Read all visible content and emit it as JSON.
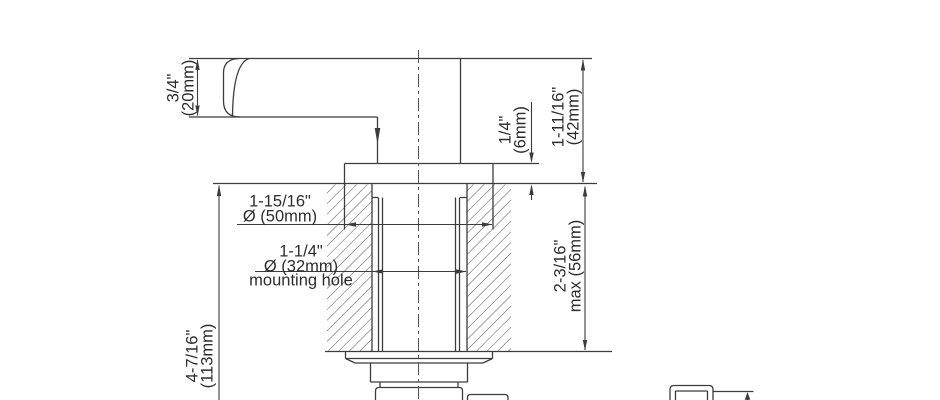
{
  "drawing": {
    "kind": "faucet-valve-installation-cross-section",
    "background": "#ffffff",
    "line_color": "#3c3c3c",
    "hatch_color": "#525252",
    "text_color": "#2d2d2d",
    "labels": {
      "handle_height": {
        "imperial": "3/4\"",
        "metric": "(20mm)"
      },
      "escutcheon_height": {
        "imperial": "1/4\"",
        "metric": "(6mm)"
      },
      "deck_to_handle_top": {
        "imperial": "1-11/16\"",
        "metric": "(42mm)"
      },
      "max_deck_thickness": {
        "imperial": "2-3/16\"",
        "metric": "max (56mm)"
      },
      "below_deck_depth": {
        "imperial": "4-7/16\"",
        "metric": "(113mm)"
      },
      "escutcheon_diameter": {
        "imperial": "1-15/16\"",
        "metric": "Ø (50mm)"
      },
      "mounting_hole": {
        "imperial": "1-1/4\"",
        "metric": "Ø (32mm)",
        "note": "mounting hole"
      }
    }
  }
}
